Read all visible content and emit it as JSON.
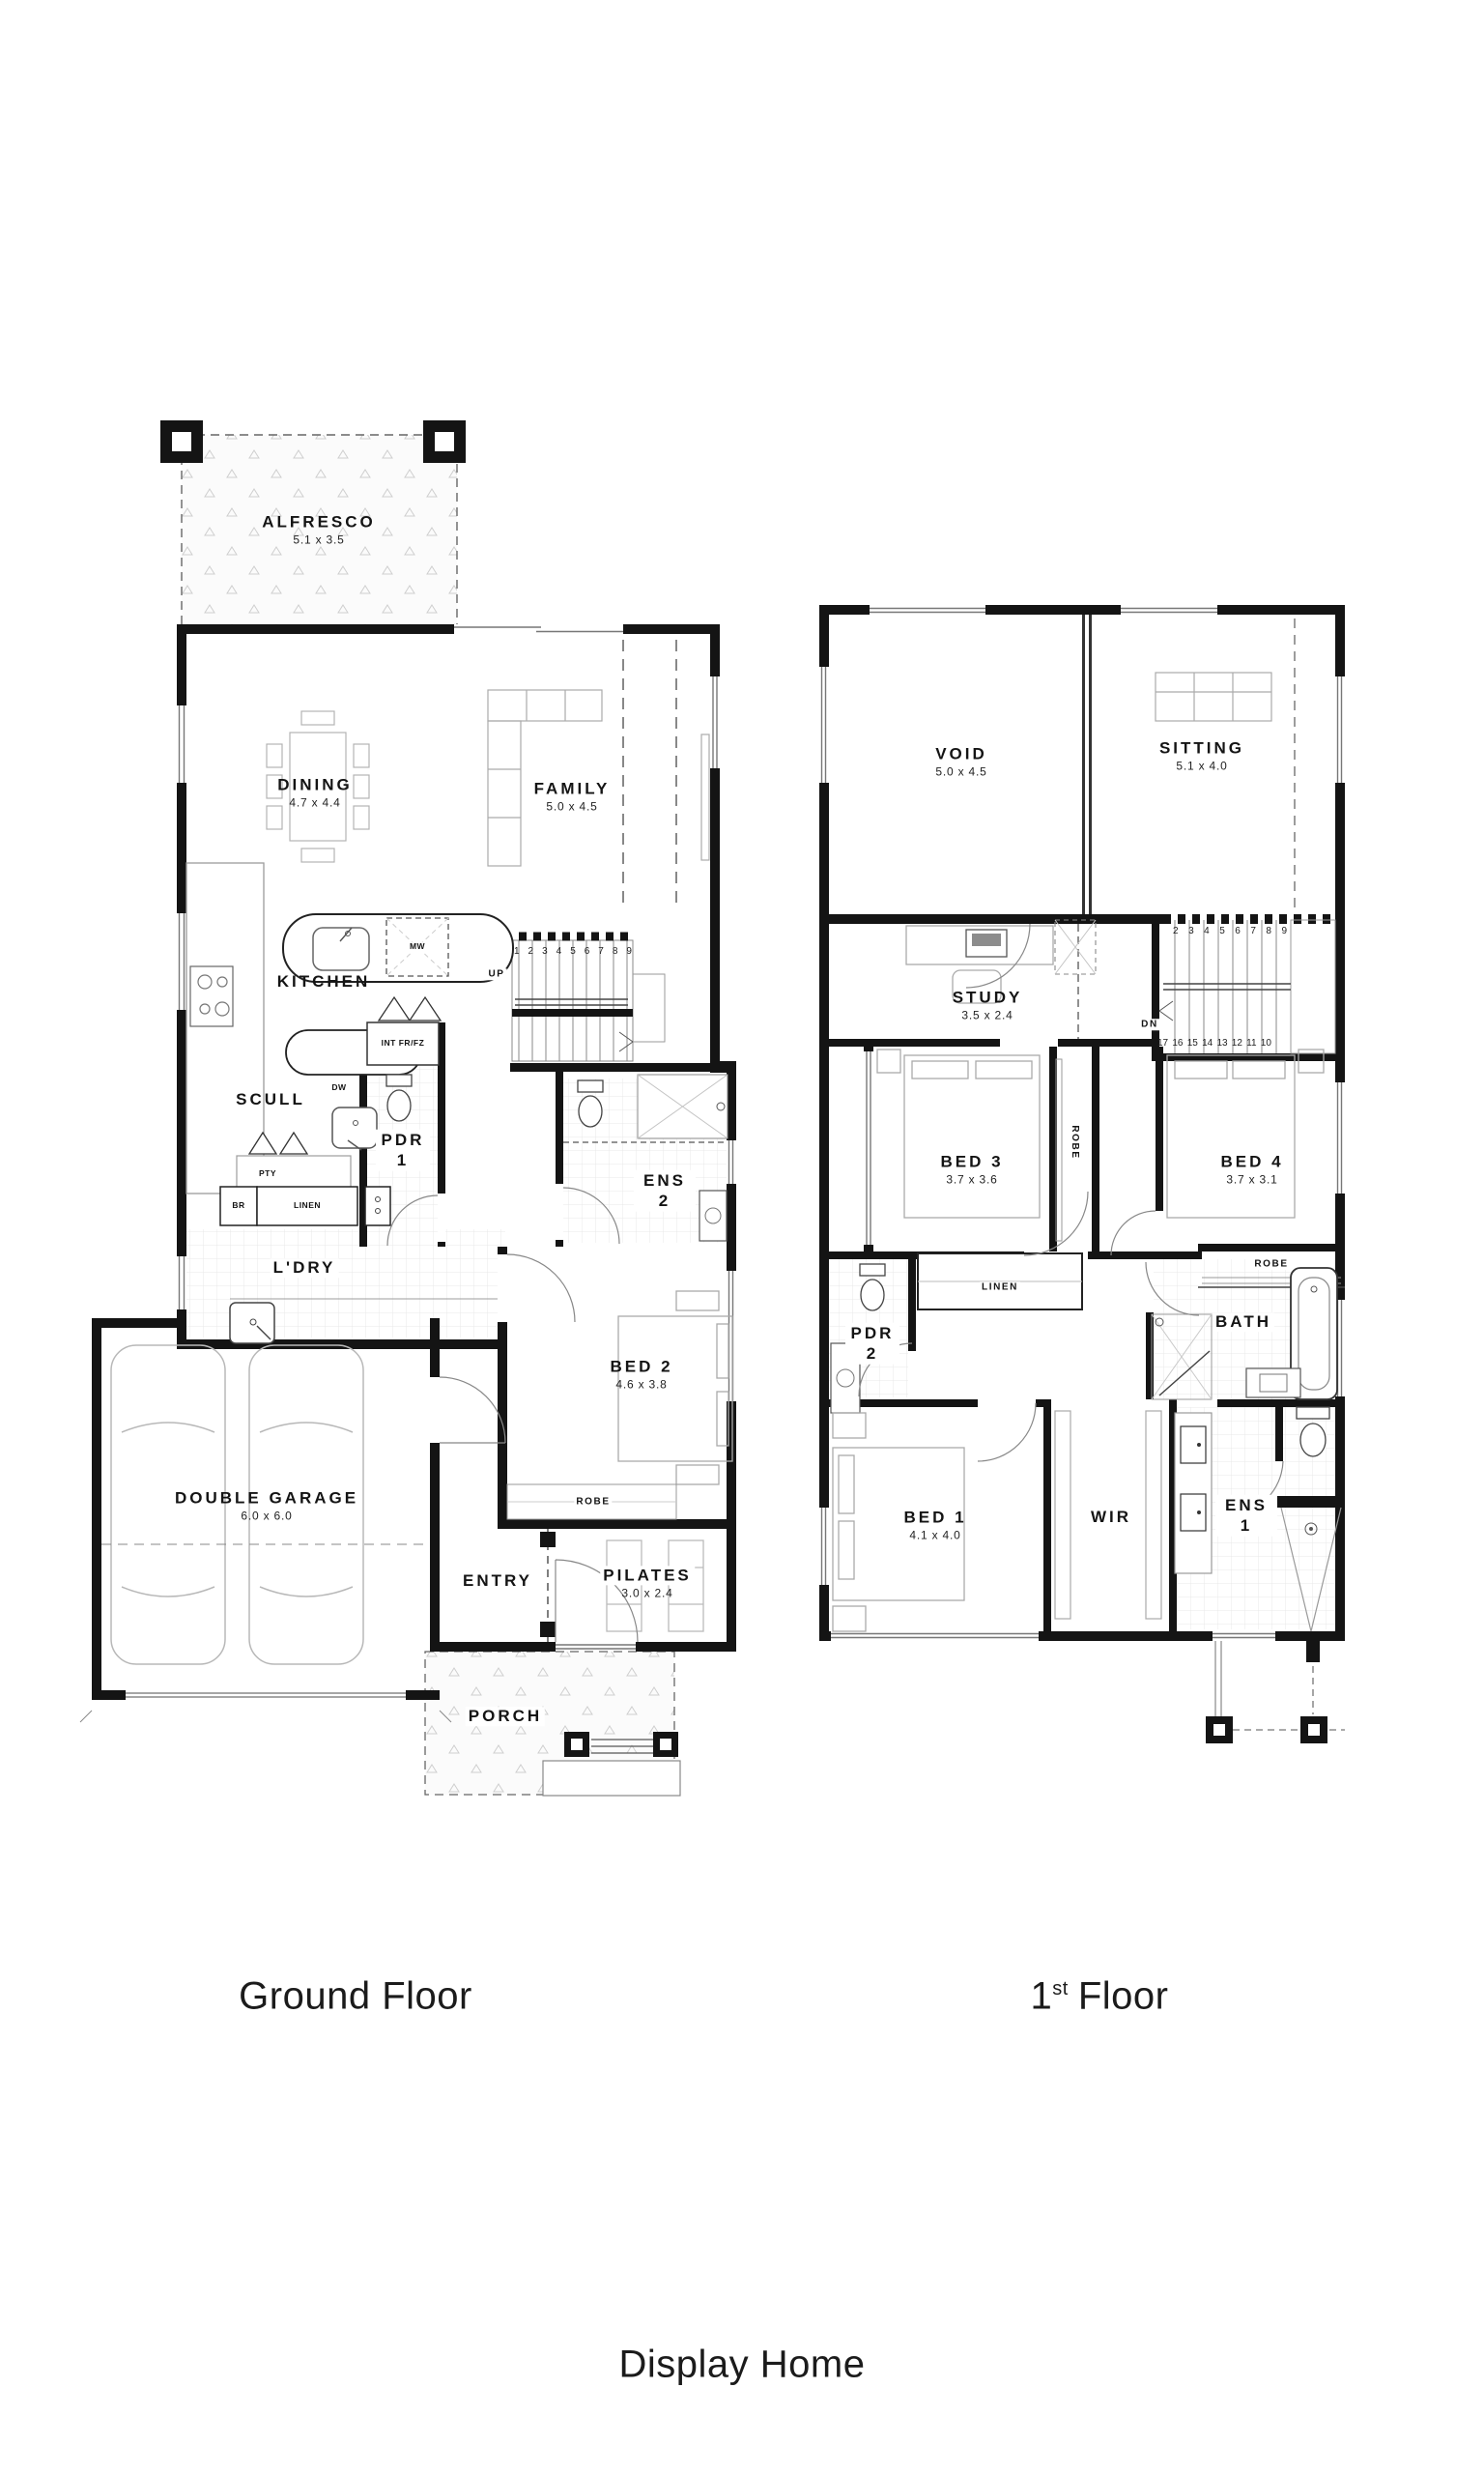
{
  "title": "Display Home",
  "ground": {
    "caption": "Ground Floor",
    "rooms": {
      "alfresco": {
        "name": "ALFRESCO",
        "dims": "5.1 x 3.5"
      },
      "dining": {
        "name": "DINING",
        "dims": "4.7 x 4.4"
      },
      "family": {
        "name": "FAMILY",
        "dims": "5.0 x 4.5"
      },
      "kitchen": {
        "name": "KITCHEN"
      },
      "scull": {
        "name": "SCULL"
      },
      "pdr1": {
        "name": "PDR 1"
      },
      "ens2": {
        "name": "ENS 2"
      },
      "ldry": {
        "name": "L'DRY"
      },
      "bed2": {
        "name": "BED 2",
        "dims": "4.6 x 3.8"
      },
      "robe": {
        "name": "ROBE"
      },
      "garage": {
        "name": "DOUBLE GARAGE",
        "dims": "6.0 x 6.0"
      },
      "entry": {
        "name": "ENTRY"
      },
      "pilates": {
        "name": "PILATES",
        "dims": "3.0 x 2.4"
      },
      "porch": {
        "name": "PORCH"
      }
    },
    "fixtures": {
      "mw": "MW",
      "dw": "DW",
      "fridge": "INT FR/FZ",
      "pty": "PTY",
      "br": "BR",
      "linen": "LINEN",
      "up": "UP"
    },
    "stairs": [
      "1",
      "2",
      "3",
      "4",
      "5",
      "6",
      "7",
      "8",
      "9"
    ]
  },
  "first": {
    "caption_num": "1",
    "caption_sup": "st",
    "caption_rest": "Floor",
    "rooms": {
      "void": {
        "name": "VOID",
        "dims": "5.0 x 4.5"
      },
      "sitting": {
        "name": "SITTING",
        "dims": "5.1 x 4.0"
      },
      "study": {
        "name": "STUDY",
        "dims": "3.5 x 2.4"
      },
      "bed3": {
        "name": "BED 3",
        "dims": "3.7 x 3.6"
      },
      "bed4": {
        "name": "BED 4",
        "dims": "3.7 x 3.1"
      },
      "robe_bed3": {
        "name": "ROBE"
      },
      "robe_bed4": {
        "name": "ROBE"
      },
      "linen": {
        "name": "LINEN"
      },
      "pdr2": {
        "name": "PDR 2"
      },
      "bath": {
        "name": "BATH"
      },
      "bed1": {
        "name": "BED 1",
        "dims": "4.1 x 4.0"
      },
      "wir": {
        "name": "WIR"
      },
      "ens1": {
        "name": "ENS 1"
      }
    },
    "fixtures": {
      "dn": "DN"
    },
    "stairs_up": [
      "2",
      "3",
      "4",
      "5",
      "6",
      "7",
      "8",
      "9"
    ],
    "stairs_down": [
      "17",
      "16",
      "15",
      "14",
      "13",
      "12",
      "11",
      "10"
    ]
  }
}
